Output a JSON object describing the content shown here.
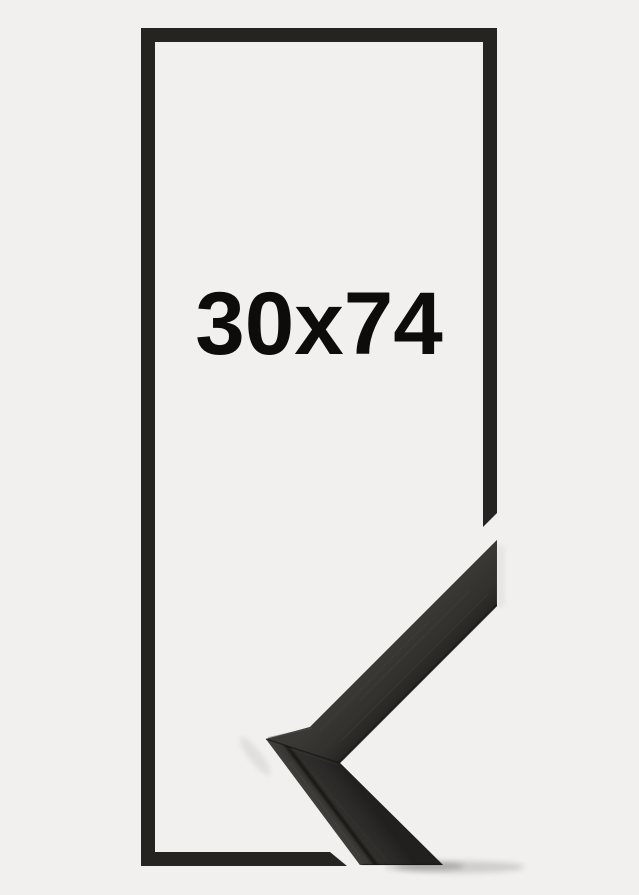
{
  "page": {
    "background_color": "#f1f0ee"
  },
  "size_diagram": {
    "label": "30x74",
    "outline_color": "#262420",
    "label_color": "#0d0c0b"
  },
  "corner_photo": {
    "icon": "frame-corner-photo",
    "surface_mid": "#2e2c29",
    "surface_light": "#413f3b",
    "surface_dark": "#22201e",
    "edge_dark": "#161512",
    "highlight": "#55524c"
  }
}
